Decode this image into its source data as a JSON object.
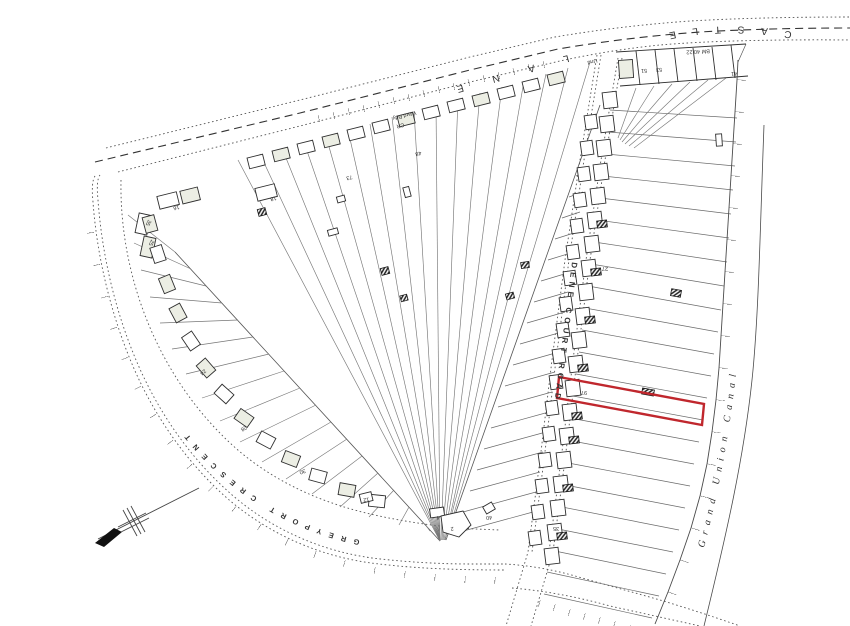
{
  "map": {
    "streets": {
      "castle": "CASTLE",
      "lane": "LANE",
      "dene_court_road": "DENE COURT ROAD",
      "greyport_crescent": "GREYPORT CRESCENT",
      "grand_union_canal": "Grand Union Canal"
    },
    "annotations": {
      "ward_boundary": "Ward Bdy",
      "county_boundary_cr": "CR",
      "undefined_boundary": "Und",
      "benchmark": "BM 40.22"
    },
    "house_numbers": [
      {
        "no": "16"
      },
      {
        "no": "48"
      },
      {
        "no": "18"
      },
      {
        "no": "73"
      },
      {
        "no": "35"
      },
      {
        "no": "25"
      },
      {
        "no": "24"
      },
      {
        "no": "28"
      },
      {
        "no": "30"
      },
      {
        "no": "12"
      },
      {
        "no": "4"
      },
      {
        "no": "2"
      },
      {
        "no": "40"
      },
      {
        "no": "51"
      },
      {
        "no": "53"
      },
      {
        "no": "41"
      },
      {
        "no": "27"
      },
      {
        "no": "97"
      },
      {
        "no": "35"
      }
    ],
    "highlight": {
      "color": "#c0272d"
    },
    "icons": {
      "north_arrow": "north-arrow"
    },
    "colors": {
      "linework": "#3a3a3a",
      "plot_lines": "#777777",
      "shaded_building": "#eceee4"
    }
  }
}
